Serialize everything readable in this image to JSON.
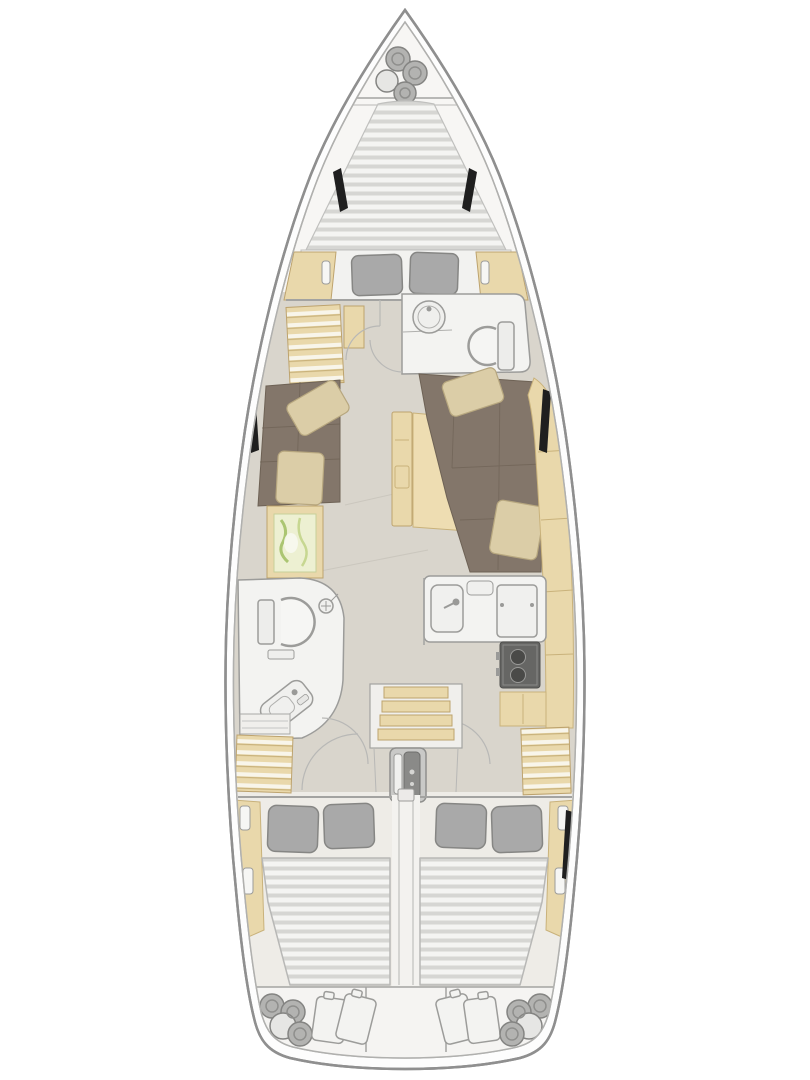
{
  "diagram": {
    "title": "Sailing yacht interior layout plan (top view, bow up)",
    "type": "yacht-floor-plan",
    "orientation": "bow-top",
    "colors": {
      "hull_line": "#8f8f8f",
      "deck": "#f7f6f4",
      "floor": "#d9d5cc",
      "floor_aft": "#eeece7",
      "wood": "#e9d8ab",
      "wood_line": "#bda36e",
      "mattress": "#f4f4f2",
      "mattress_stripe": "#d6d6d3",
      "pillow": "#a9a9a9",
      "settee": "#83766a",
      "settee_line": "#6e6255",
      "cushion": "#dbcda7",
      "map_green": "#edf0d2",
      "fixture": "#f3f3f1",
      "fixture_line": "#9c9c9a",
      "stove": "#666664",
      "burner": "#4a4a48",
      "window": "#1f1f1f",
      "fender": "#b3b3b1",
      "engine": "#c9c9c7",
      "engine_dark": "#8a8a88"
    },
    "areas": [
      {
        "id": "anchor-locker",
        "label": "anchor locker",
        "contents": "4 fenders"
      },
      {
        "id": "forward-berth",
        "label": "forward cabin V-berth",
        "contents": "striped mattress, 2 gray pillows"
      },
      {
        "id": "forward-head",
        "label": "forward head",
        "contents": "round washbasin, toilet"
      },
      {
        "id": "port-wardrobe",
        "label": "port shelved wardrobe"
      },
      {
        "id": "salon",
        "label": "salon",
        "contents": "port settee with 2 cushions, starboard U-settee with 2 cushions, folding table, chart table with map"
      },
      {
        "id": "galley",
        "label": "galley",
        "contents": "double sink with faucet, refrigerator, 2-burner stove"
      },
      {
        "id": "aft-head",
        "label": "aft head (port)",
        "contents": "toilet, shower head, tilted vanity basin"
      },
      {
        "id": "companionway",
        "label": "companionway",
        "contents": "4 wooden steps, engine compartment"
      },
      {
        "id": "port-aft-cabin",
        "label": "port aft cabin",
        "contents": "double berth, 2 gray pillows, slatted locker"
      },
      {
        "id": "starboard-aft-cabin",
        "label": "starboard aft cabin",
        "contents": "double berth, 2 gray pillows, slatted locker"
      },
      {
        "id": "stern-lockers",
        "label": "stern lazarette lockers",
        "contents": "4 fenders and 2 bags each side, empty center"
      }
    ],
    "counts": {
      "bow_fenders": 4,
      "stern_fenders_port": 4,
      "stern_fenders_starboard": 4,
      "companionway_steps": 4,
      "hull_windows": 6
    }
  }
}
